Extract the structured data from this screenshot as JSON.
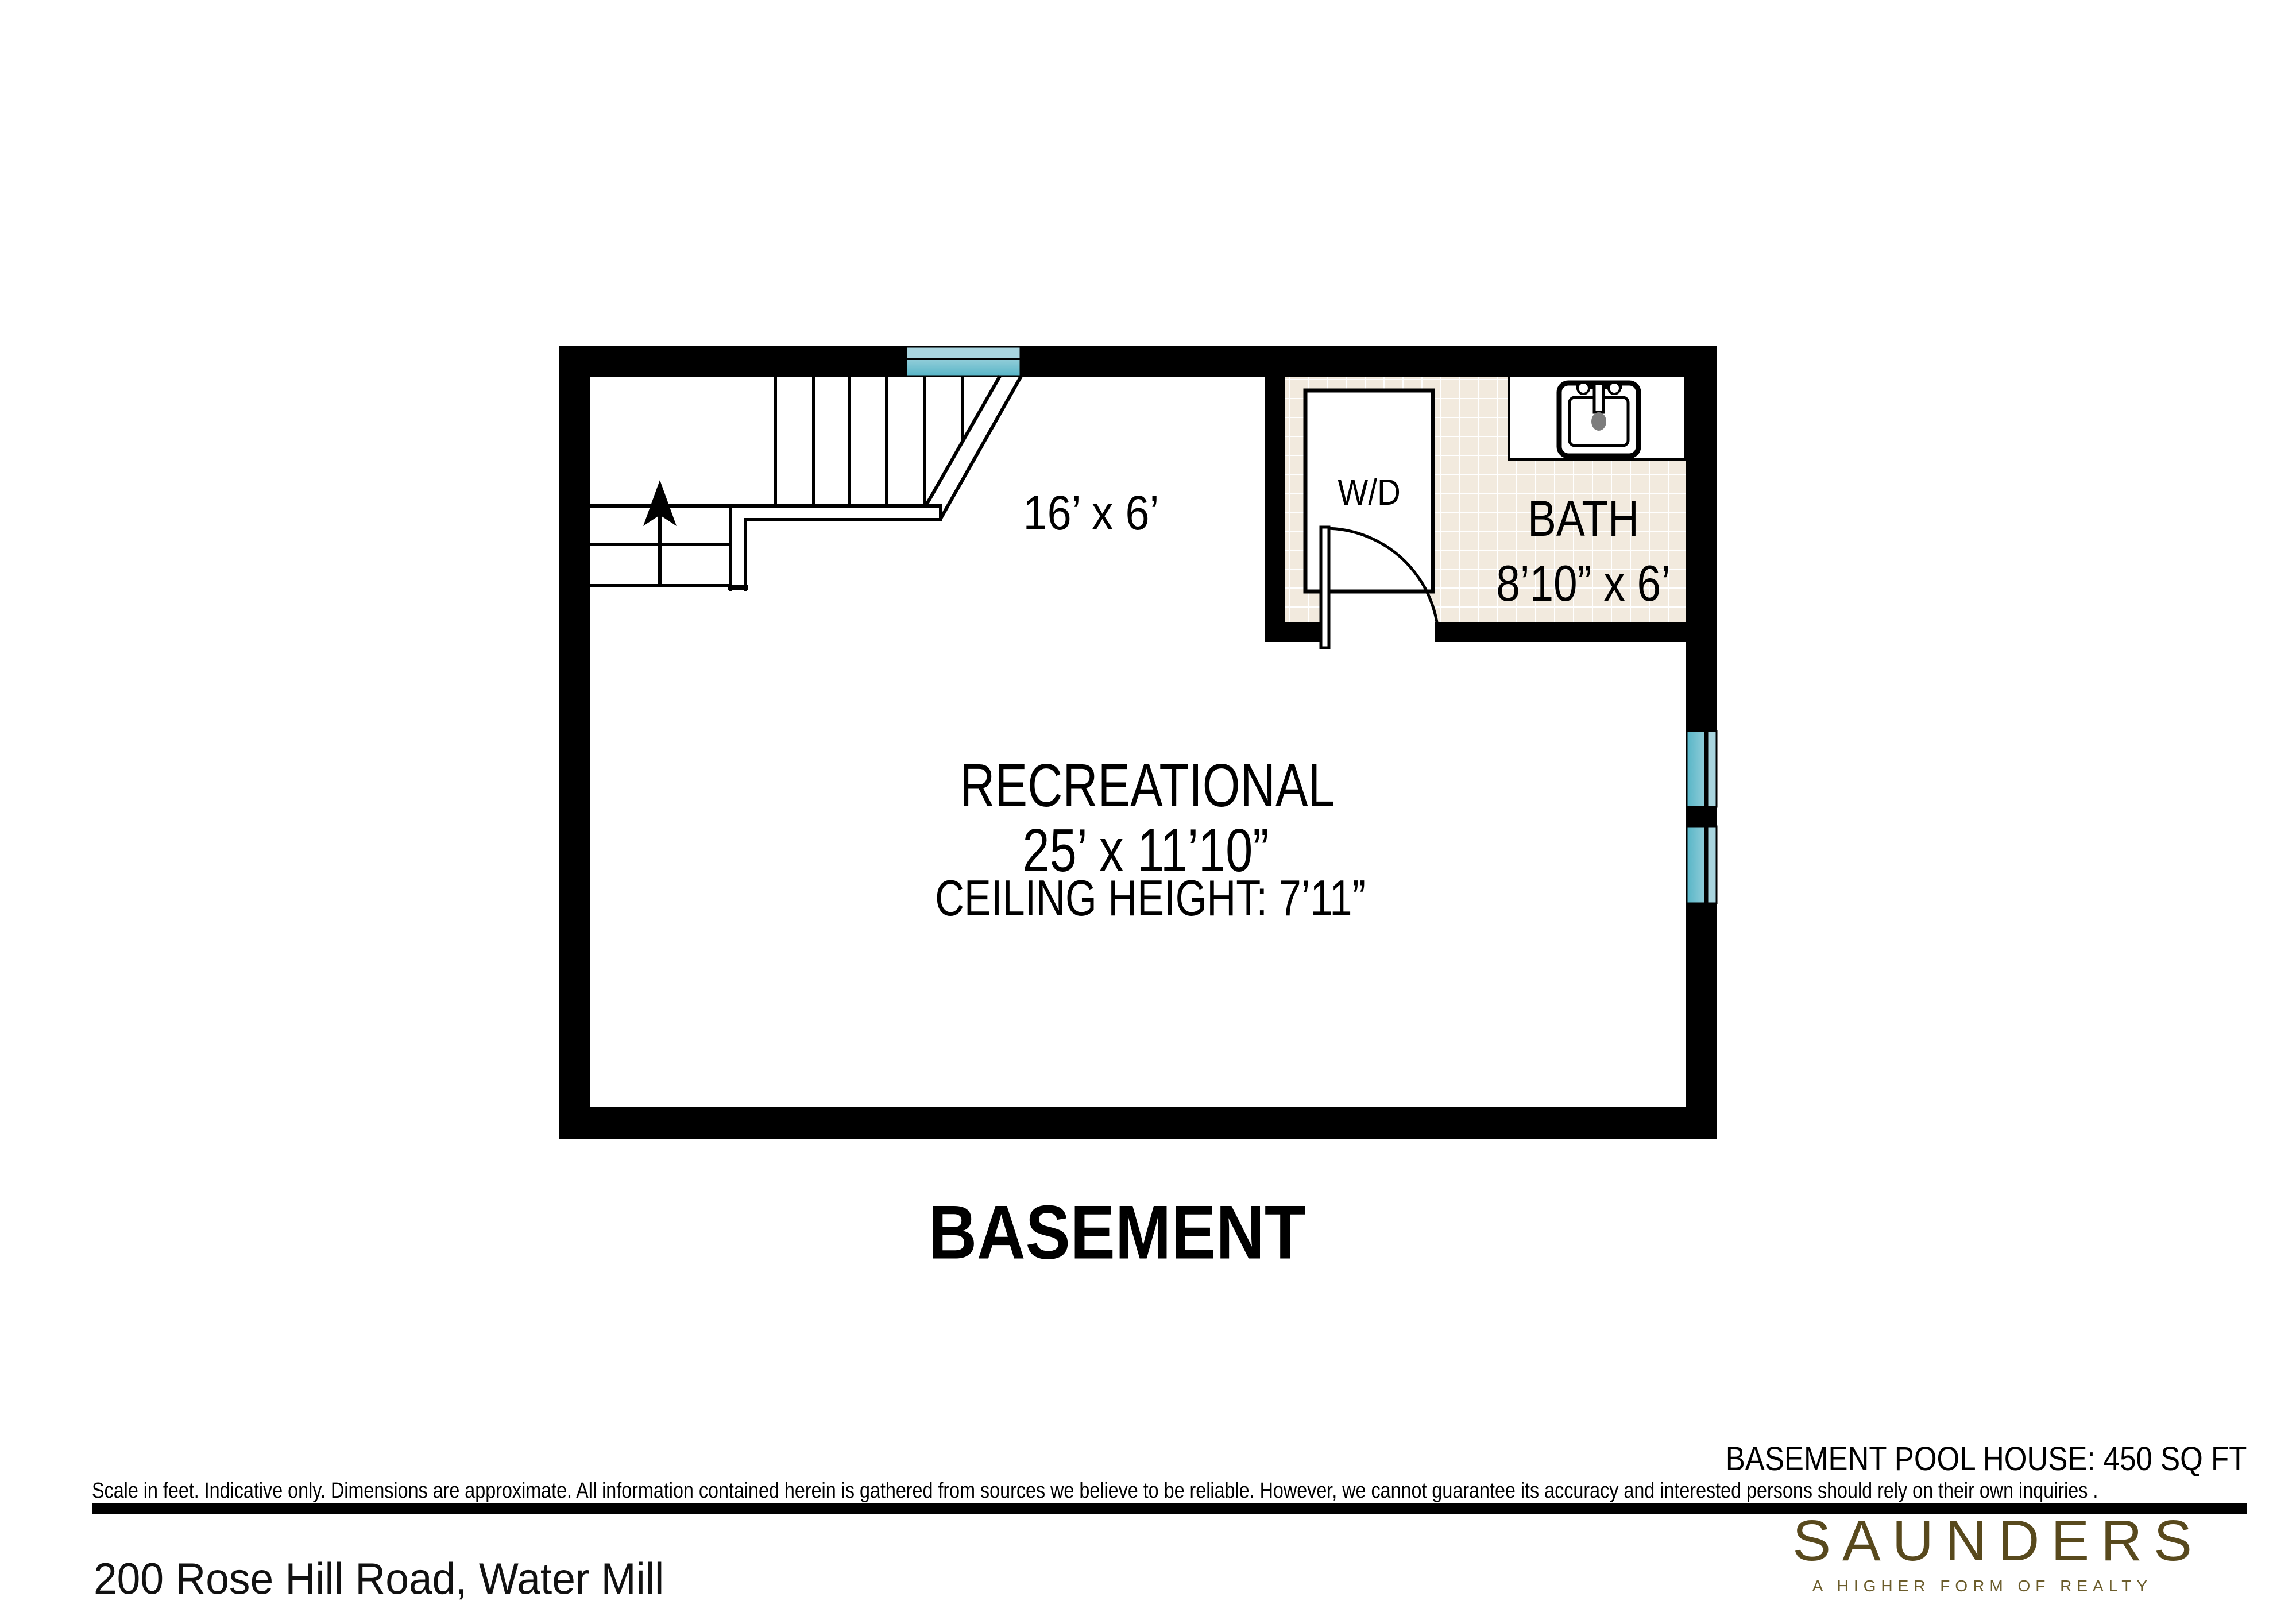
{
  "plan": {
    "stairs_dims": "16’ x 6’",
    "wd_label": "W/D",
    "bath_name": "BATH",
    "bath_dims": "8’10” x 6’",
    "room_name": "RECREATIONAL",
    "room_dims": "25’ x 11’10”",
    "ceiling": "CEILING HEIGHT: 7’11”",
    "floor_title": "BASEMENT"
  },
  "footer": {
    "area_summary": "BASEMENT POOL HOUSE: 450 SQ FT",
    "disclaimer": "Scale in feet. Indicative only. Dimensions are approximate. All information contained herein is gathered from sources we believe to be reliable. However, we cannot guarantee its accuracy and interested persons should rely on their own inquiries .",
    "address": "200 Rose Hill Road, Water Mill"
  },
  "brand": {
    "name": "SAUNDERS",
    "tagline": "A HIGHER FORM OF REALTY"
  },
  "colors": {
    "wall": "#000000",
    "window_teal_dark": "#5fb7c7",
    "window_teal_mid": "#8fccd8",
    "window_teal_light": "#a9d5df",
    "tile_fill": "#f2eade",
    "tile_grout": "#ffffff",
    "logo_olive": "#58491d",
    "drain_gray": "#7d7d7d"
  }
}
